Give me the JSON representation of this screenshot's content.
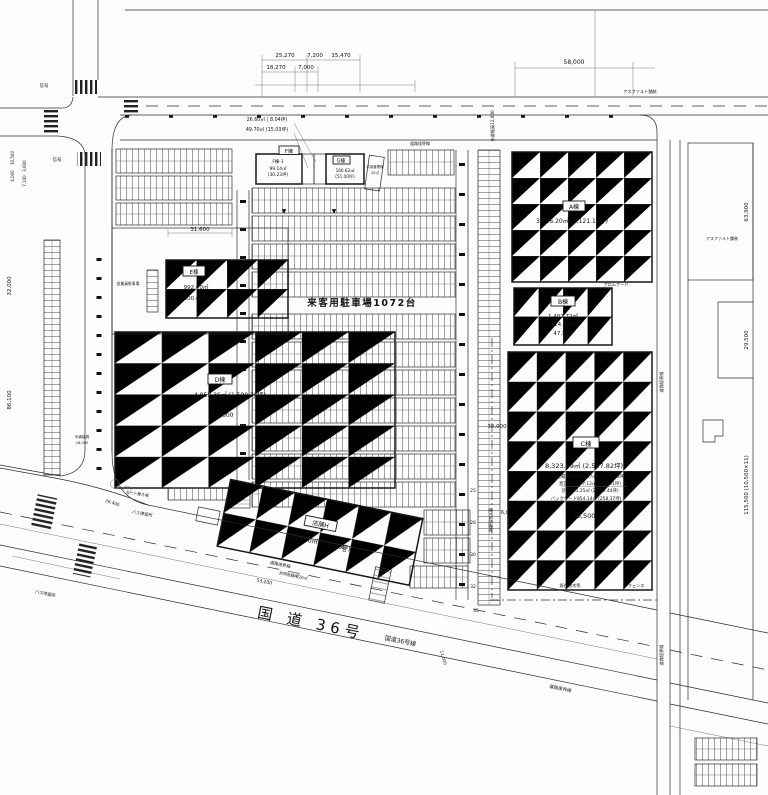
{
  "buildings": {
    "a": {
      "label": "A棟",
      "area": "3,706.20㎡ (1,121.12坪)"
    },
    "b": {
      "label": "B棟",
      "area1": "1,402.72㎡",
      "area2": "(424.32坪)",
      "dim": "47,550"
    },
    "c": {
      "label": "C棟",
      "area": "8,323.39㎡ (2,517.82坪)",
      "sub1": "(売場) 内6,995.17㎡ (2,116.93坪)",
      "sub2": "直営売場477.12㎡ (192.91坪)",
      "sub3": "計7,465.25㎡ (2,256.44坪)",
      "sub4": "バックヤード854.14㎡ (258.37坪)",
      "dim_w": "70,500",
      "dim_h": "30,000",
      "dim_s": "6,000"
    },
    "d": {
      "label": "D棟",
      "area": "4,959.36㎡ (1,500.20坪)",
      "dim": "57,600"
    },
    "e": {
      "label": "E棟",
      "area1": "992.00㎡",
      "area2": "(300.08坪)"
    },
    "f": {
      "label": "F棟",
      "unit": "F棟-1",
      "area1": "99.14㎡",
      "area2": "(30.23坪)",
      "note1": "26.60㎡ ( 8.04坪)",
      "note2": "49.70㎡ (15.03坪)"
    },
    "g": {
      "label": "G棟",
      "area1": "166.62㎡",
      "area2": "(51.00坪)"
    },
    "h": {
      "label": "店舗H",
      "area": "1,489.60㎡ (450.60坪)"
    },
    "mgmt": {
      "name": "共用管理棟",
      "area": "20㎡"
    }
  },
  "parking": {
    "main": "来客用駐車場1072台",
    "counts": [
      "25",
      "28",
      "30",
      "32",
      "35"
    ],
    "employee": "従業員駐車場",
    "cart": "カート置き場",
    "bicycle": "共同駐輪場20㎡"
  },
  "roads": {
    "route36": "国 道 36号",
    "route36_line": "国道36号線",
    "boundary": "道路境界線",
    "sidewalk_n": "歩道幅員12,000",
    "sidewalk_w": "歩道幅員",
    "service": "搬入車両動線"
  },
  "site": {
    "asphalt": "アスファルト舗装",
    "fence": "フェンス",
    "trees": "既存樹木等",
    "signal": "信号",
    "promenade": "プロムナード",
    "bus": "バス停留所"
  },
  "dims": {
    "t1": "25,270",
    "t2": "7,200",
    "t3": "15,470",
    "t4": "18,270",
    "t5": "7,000",
    "t6": "58,000",
    "l1": "10,500",
    "l2": "4,000",
    "l3": "3,600",
    "l4": "7,100",
    "l5": "32,000",
    "l6": "86,100",
    "l7": "31,600",
    "l8": "18,000",
    "r1": "63,900",
    "r2": "29,500",
    "r3": "115,500 (10,500×11)",
    "b1": "53,200",
    "b2": "38,000",
    "b3": "26,400",
    "b4": "11,000"
  }
}
